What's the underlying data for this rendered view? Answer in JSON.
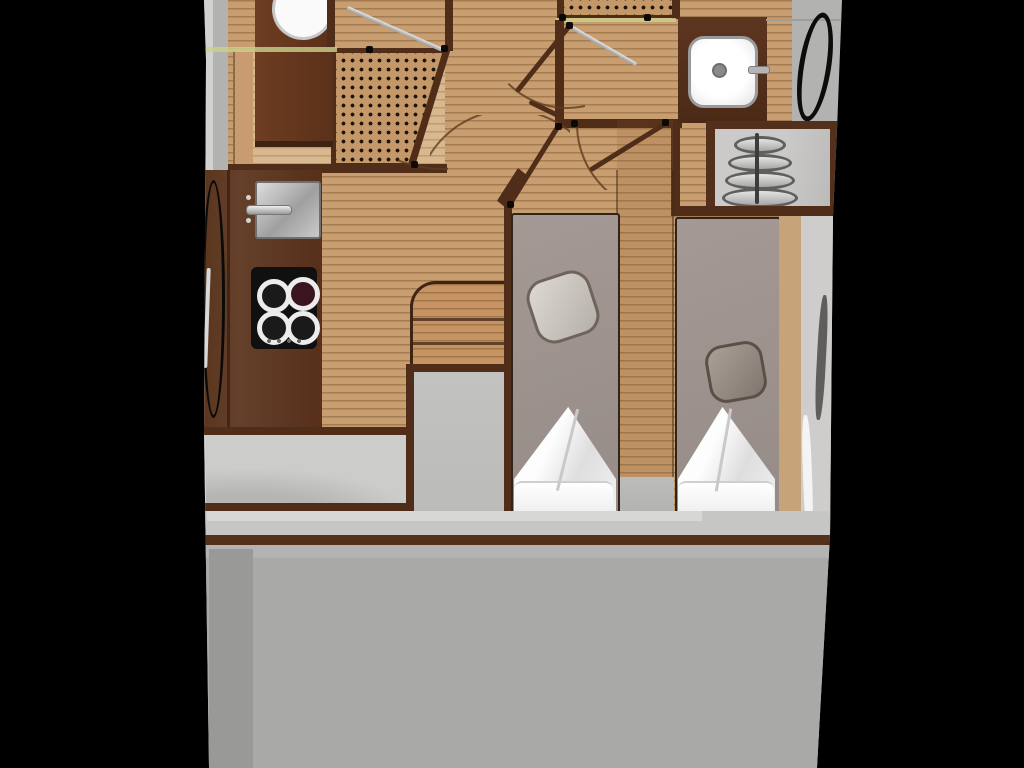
{
  "scene": {
    "kind": "yacht-interior-floor-plan",
    "view": "top-down",
    "visible_text": [],
    "page_background": "#000000"
  },
  "colors": {
    "page-bg": "#000000",
    "wood": "#c89d6f",
    "wood-light": "#d9b88f",
    "wood-line": "rgba(97,62,28,0.35)",
    "grating-tan": "#c49869",
    "dot": "#1d1309",
    "walnut": "#4f2d18",
    "counter": "#5f3a23",
    "cabinet": "#653821",
    "hull-gray": "#b2b2b0",
    "hull-rim": "#d6d6d4",
    "stairs-panel": "#cbcac8",
    "saloon-gray": "#cccccb",
    "box-gray": "#babab8",
    "band-gray": "#c6c6c4",
    "deck-gray": "#a9a9a7",
    "deck-dark": "#999997",
    "bed-taupe": "#a09490",
    "bed-outline": "#30231a",
    "cushion-light": "#d5d0cb",
    "cushion-dark": "#90867e",
    "toilet-beige": "#e8d7bc",
    "pillow-white": "#fdfdfd",
    "steel": "#c9c9c7",
    "accent-green": "#ccd28d"
  },
  "fixtures": [
    {
      "id": "vanity-sink",
      "kind": "sink",
      "area": "port-forward cabinet"
    },
    {
      "id": "forward-toilet",
      "kind": "toilet",
      "area": "forward head"
    },
    {
      "id": "forward-shower-grating",
      "kind": "shower-grating",
      "area": "forward head"
    },
    {
      "id": "forward-shower-door",
      "kind": "glass-door",
      "area": "forward head"
    },
    {
      "id": "hull-window-port",
      "kind": "hull-window",
      "area": "port side"
    },
    {
      "id": "galley-sink",
      "kind": "sink",
      "area": "galley"
    },
    {
      "id": "galley-faucet",
      "kind": "faucet",
      "area": "galley"
    },
    {
      "id": "cooktop",
      "kind": "stove",
      "burners": 4,
      "area": "galley"
    },
    {
      "id": "aft-shower-grating",
      "kind": "shower-grating",
      "area": "aft head"
    },
    {
      "id": "aft-shower-door",
      "kind": "glass-door",
      "area": "aft head"
    },
    {
      "id": "washbasin",
      "kind": "sink",
      "area": "aft head"
    },
    {
      "id": "porthole-starboard",
      "kind": "porthole",
      "area": "starboard side"
    },
    {
      "id": "companionway-stairs",
      "kind": "stairs",
      "steps": 4,
      "area": "starboard"
    },
    {
      "id": "cabin-steps",
      "kind": "steps",
      "steps": 3,
      "area": "center"
    },
    {
      "id": "bed-port",
      "kind": "single-berth",
      "area": "cabin"
    },
    {
      "id": "bed-starboard",
      "kind": "single-berth",
      "area": "cabin"
    },
    {
      "id": "cushion-port",
      "kind": "decor-cushion"
    },
    {
      "id": "cushion-starboard",
      "kind": "decor-cushion"
    },
    {
      "id": "pillows-port",
      "kind": "pillow-set"
    },
    {
      "id": "pillows-starboard",
      "kind": "pillow-set"
    },
    {
      "id": "door-swings",
      "kind": "door-swing",
      "count": 4
    },
    {
      "id": "hinge-points",
      "kind": "hinge-dot",
      "count": 10
    }
  ]
}
